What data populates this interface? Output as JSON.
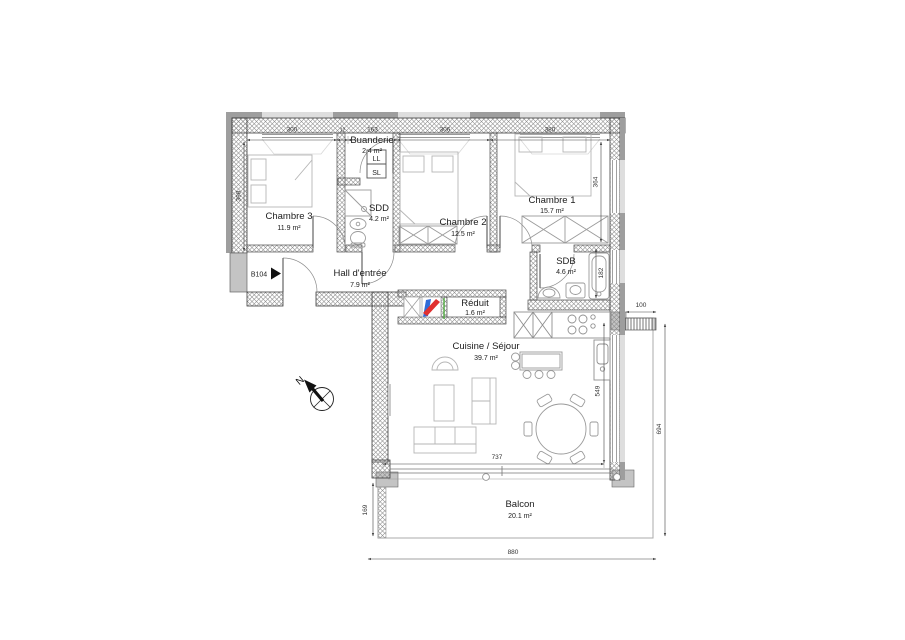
{
  "plan": {
    "unit_badge": "B104",
    "north_letter": "N"
  },
  "rooms": [
    {
      "id": "chambre3",
      "name": "Chambre 3",
      "area": "11.9 m²"
    },
    {
      "id": "buanderie",
      "name": "Buanderie",
      "area": "2.4 m²"
    },
    {
      "id": "sdd",
      "name": "SDD",
      "area": "4.2 m²"
    },
    {
      "id": "chambre2",
      "name": "Chambre 2",
      "area": "12.5 m²"
    },
    {
      "id": "chambre1",
      "name": "Chambre 1",
      "area": "15.7 m²"
    },
    {
      "id": "sdb",
      "name": "SDB",
      "area": "4.6 m²"
    },
    {
      "id": "hall",
      "name": "Hall d'entrée",
      "area": "7.9 m²"
    },
    {
      "id": "reduit",
      "name": "Réduit",
      "area": "1.6 m²"
    },
    {
      "id": "cuisine",
      "name": "Cuisine / Séjour",
      "area": "39.7 m²"
    },
    {
      "id": "balcon",
      "name": "Balcon",
      "area": "20.1 m²"
    }
  ],
  "appliances": {
    "washing_machine": "LL",
    "dryer": "SL"
  },
  "dimensions": {
    "top_chambre3": "300",
    "top_wall": "12",
    "top_buanderie": "163",
    "top_chambre2": "306",
    "top_chambre1": "380",
    "left_chambre3": "398",
    "right_chambre1": "364",
    "sdb_bathtub": "182",
    "balcony_wall": "100",
    "living_height": "549",
    "balcony_right_total": "694",
    "living_width": "737",
    "bottom_total": "880",
    "balcony_depth": "169"
  },
  "colors": {
    "wall_outline": "#3d3d3d",
    "facade_band": "#9e9e9e",
    "window_band": "#dedede",
    "furniture": "#b5b5b5",
    "shaft_red": "#e03030",
    "shaft_blue": "#2f6bd8",
    "shaft_green": "#4ea83e"
  }
}
